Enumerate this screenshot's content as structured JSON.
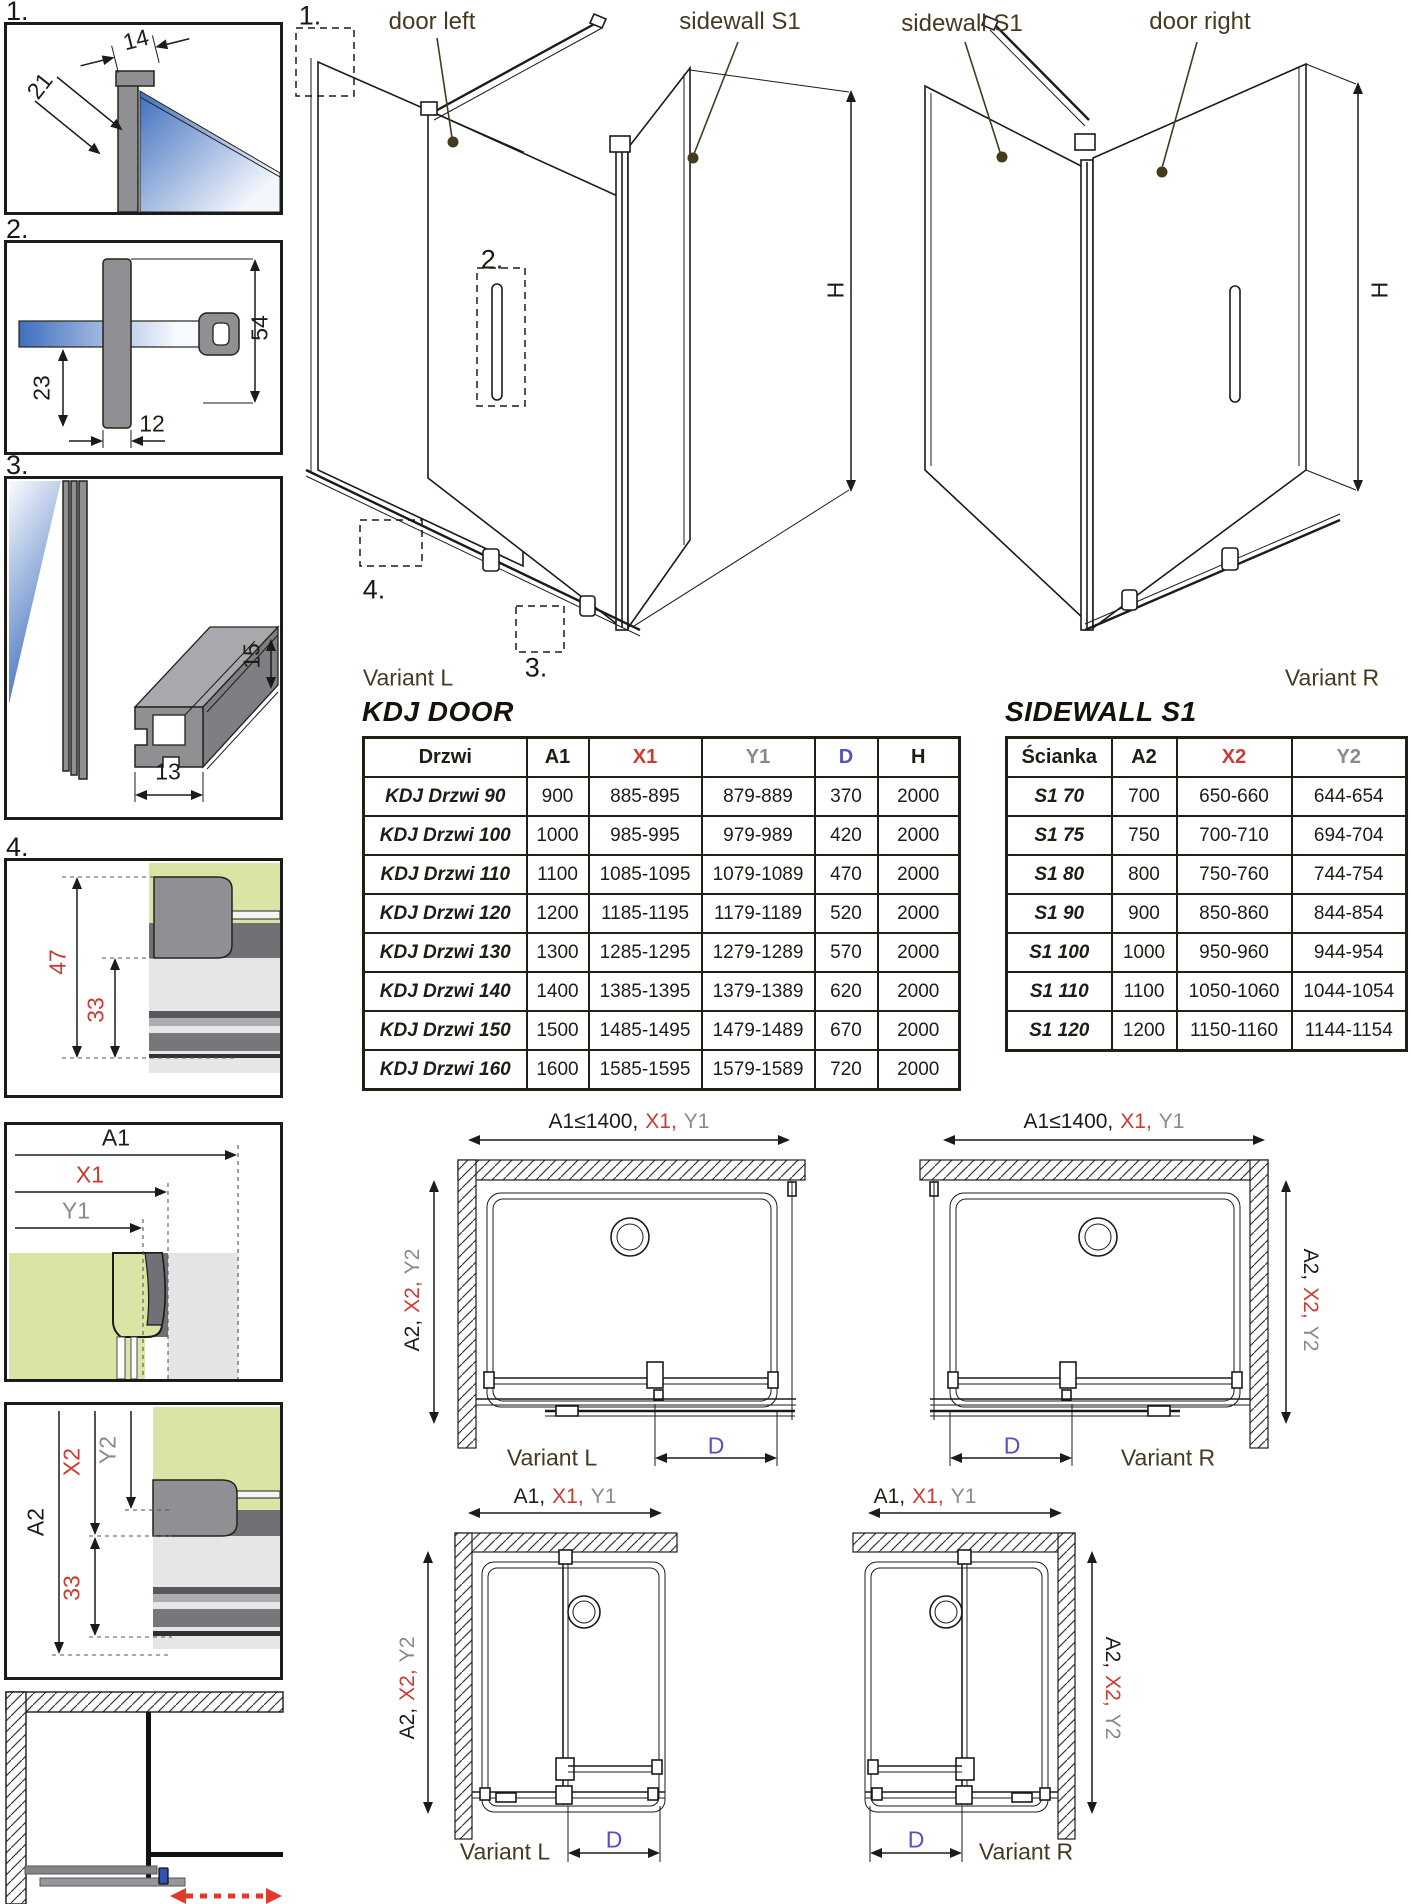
{
  "colors": {
    "ink": "#1f1c16",
    "label_brown": "#463a20",
    "accent_red": "#cc3b32",
    "accent_gray": "#8a8a8a",
    "accent_blue": "#5551bd",
    "glass_blue": "#4a77c2",
    "glass_green": "#d9e5a5",
    "profile_gray": "#8f9094",
    "red_arrow": "#e03a2a"
  },
  "details": {
    "item1": {
      "num": "1.",
      "dim_width": "14",
      "dim_depth": "21"
    },
    "item2": {
      "num": "2.",
      "dim_height": "54",
      "dim_inner": "23",
      "dim_width": "12"
    },
    "item3": {
      "num": "3.",
      "dim_height": "15",
      "dim_width": "13"
    },
    "item4": {
      "num": "4.",
      "dim_outer": "47",
      "dim_inner": "33"
    },
    "plan_detail_h": {
      "a": "A1",
      "x": "X1",
      "y": "Y1"
    },
    "plan_detail_v": {
      "a": "A2",
      "x": "X2",
      "y": "Y2",
      "inner": "33"
    }
  },
  "iso_left": {
    "marker1": "1.",
    "marker2": "2.",
    "marker3": "3.",
    "marker4": "4.",
    "door_label": "door left",
    "sidewall_label": "sidewall S1",
    "height_label": "H",
    "variant": "Variant L"
  },
  "iso_right": {
    "sidewall_label": "sidewall S1",
    "door_label": "door right",
    "height_label": "H",
    "variant": "Variant R"
  },
  "door_table": {
    "title": "KDJ DOOR",
    "headers": [
      "Drzwi",
      "A1",
      "X1",
      "Y1",
      "D",
      "H"
    ],
    "rows": [
      [
        "KDJ Drzwi 90",
        "900",
        "885-895",
        "879-889",
        "370",
        "2000"
      ],
      [
        "KDJ Drzwi 100",
        "1000",
        "985-995",
        "979-989",
        "420",
        "2000"
      ],
      [
        "KDJ Drzwi 110",
        "1100",
        "1085-1095",
        "1079-1089",
        "470",
        "2000"
      ],
      [
        "KDJ Drzwi 120",
        "1200",
        "1185-1195",
        "1179-1189",
        "520",
        "2000"
      ],
      [
        "KDJ Drzwi 130",
        "1300",
        "1285-1295",
        "1279-1289",
        "570",
        "2000"
      ],
      [
        "KDJ Drzwi 140",
        "1400",
        "1385-1395",
        "1379-1389",
        "620",
        "2000"
      ],
      [
        "KDJ Drzwi 150",
        "1500",
        "1485-1495",
        "1479-1489",
        "670",
        "2000"
      ],
      [
        "KDJ Drzwi 160",
        "1600",
        "1585-1595",
        "1579-1589",
        "720",
        "2000"
      ]
    ]
  },
  "sidewall_table": {
    "title": "SIDEWALL S1",
    "headers": [
      "Ścianka",
      "A2",
      "X2",
      "Y2"
    ],
    "rows": [
      [
        "S1 70",
        "700",
        "650-660",
        "644-654"
      ],
      [
        "S1 75",
        "750",
        "700-710",
        "694-704"
      ],
      [
        "S1 80",
        "800",
        "750-760",
        "744-754"
      ],
      [
        "S1 90",
        "900",
        "850-860",
        "844-854"
      ],
      [
        "S1 100",
        "1000",
        "950-960",
        "944-954"
      ],
      [
        "S1 110",
        "1100",
        "1050-1060",
        "1044-1054"
      ],
      [
        "S1 120",
        "1200",
        "1150-1160",
        "1144-1154"
      ]
    ]
  },
  "plans": {
    "top_left": {
      "dim_a": "A1≤1400,",
      "dim_x": "X1,",
      "dim_y": "Y1",
      "side_a": "A2,",
      "side_x": "X2,",
      "side_y": "Y2",
      "door_dim": "D",
      "variant": "Variant L"
    },
    "top_right": {
      "dim_a": "A1≤1400,",
      "dim_x": "X1,",
      "dim_y": "Y1",
      "side_a": "A2,",
      "side_x": "X2,",
      "side_y": "Y2",
      "door_dim": "D",
      "variant": "Variant R"
    },
    "bottom_left": {
      "dim_a": "A1,",
      "dim_x": "X1,",
      "dim_y": "Y1",
      "side_a": "A2,",
      "side_x": "X2,",
      "side_y": "Y2",
      "door_dim": "D",
      "variant": "Variant L"
    },
    "bottom_right": {
      "dim_a": "A1,",
      "dim_x": "X1,",
      "dim_y": "Y1",
      "side_a": "A2,",
      "side_x": "X2,",
      "side_y": "Y2",
      "door_dim": "D",
      "variant": "Variant R"
    }
  }
}
